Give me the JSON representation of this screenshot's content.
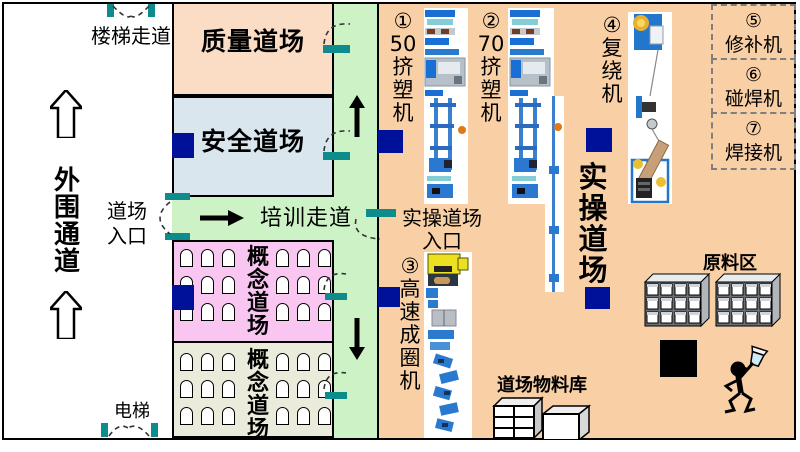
{
  "colors": {
    "quality_bg": "#fbdcc5",
    "safety_bg": "#d9e6ee",
    "corridor_green": "#ccf2c6",
    "concept_upper_bg": "#f9c6f2",
    "concept_lower_bg": "#eaebda",
    "practical_bg": "#f9cfa5",
    "pillar_navy": "#001199",
    "door_teal": "#0e8b8b",
    "dashed_gray": "#7f7f7f"
  },
  "outer_corridor": {
    "label": "外\n围\n通\n道",
    "stair_label": "楼梯走道",
    "dojo_entrance_label": "道场\n入口",
    "elevator_label": "电梯"
  },
  "rooms": {
    "quality": {
      "label": "质量道场"
    },
    "safety": {
      "label": "安全道场"
    },
    "training_corridor": {
      "label": "培训走道"
    },
    "concept_upper": {
      "label": "概\n念\n道\n场"
    },
    "concept_lower": {
      "label": "概\n念\n道\n场"
    },
    "practical": {
      "label": "实\n操\n道\n场",
      "entrance_label": "实操道场\n入口"
    }
  },
  "machines": {
    "m1": {
      "label": "①\n50\n挤\n塑\n机"
    },
    "m2": {
      "label": "②\n70\n挤\n塑\n机"
    },
    "m3": {
      "label": "③\n高\n速\n成\n圈\n机"
    },
    "m4": {
      "label": "④\n复\n绕\n机"
    },
    "m5": {
      "label": "⑤\n修补机"
    },
    "m6": {
      "label": "⑥\n碰焊机"
    },
    "m7": {
      "label": "⑦\n焊接机"
    }
  },
  "storage": {
    "material_store_label": "道场物料库",
    "raw_material_label": "原料区"
  }
}
